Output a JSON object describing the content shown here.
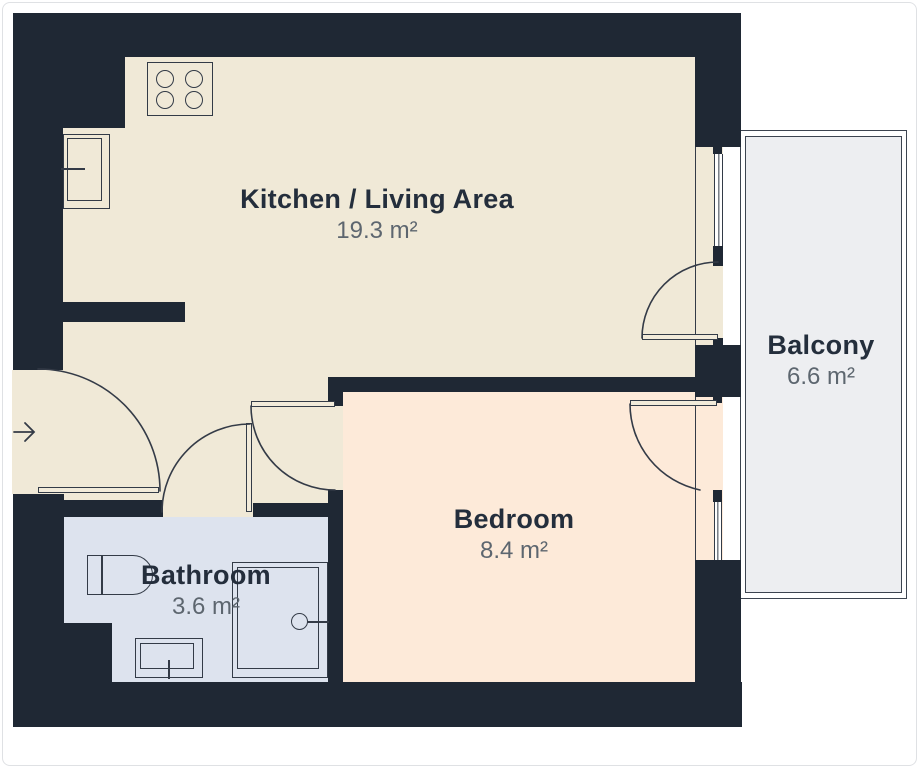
{
  "rooms": {
    "kitchen_living": {
      "name": "Kitchen / Living Area",
      "area": "19.3 m²"
    },
    "bedroom": {
      "name": "Bedroom",
      "area": "8.4 m²"
    },
    "bathroom": {
      "name": "Bathroom",
      "area": "3.6 m²"
    },
    "balcony": {
      "name": "Balcony",
      "area": "6.6 m²"
    }
  },
  "icons": {
    "entry_arrow": "right-arrow",
    "stove": "four-burner-stove",
    "counter": "kitchen-counter-unit",
    "toilet": "toilet",
    "sink": "bathroom-sink",
    "shower": "shower-enclosure"
  },
  "colors": {
    "wall": "#1f2834",
    "kitchen_floor": "#f0e9d7",
    "bedroom_floor": "#fdead9",
    "bathroom_floor": "#dde3ee",
    "balcony_floor": "#edeef1",
    "outline": "#343b47",
    "room_name_text": "#242e3c",
    "area_text": "#5d666f"
  }
}
